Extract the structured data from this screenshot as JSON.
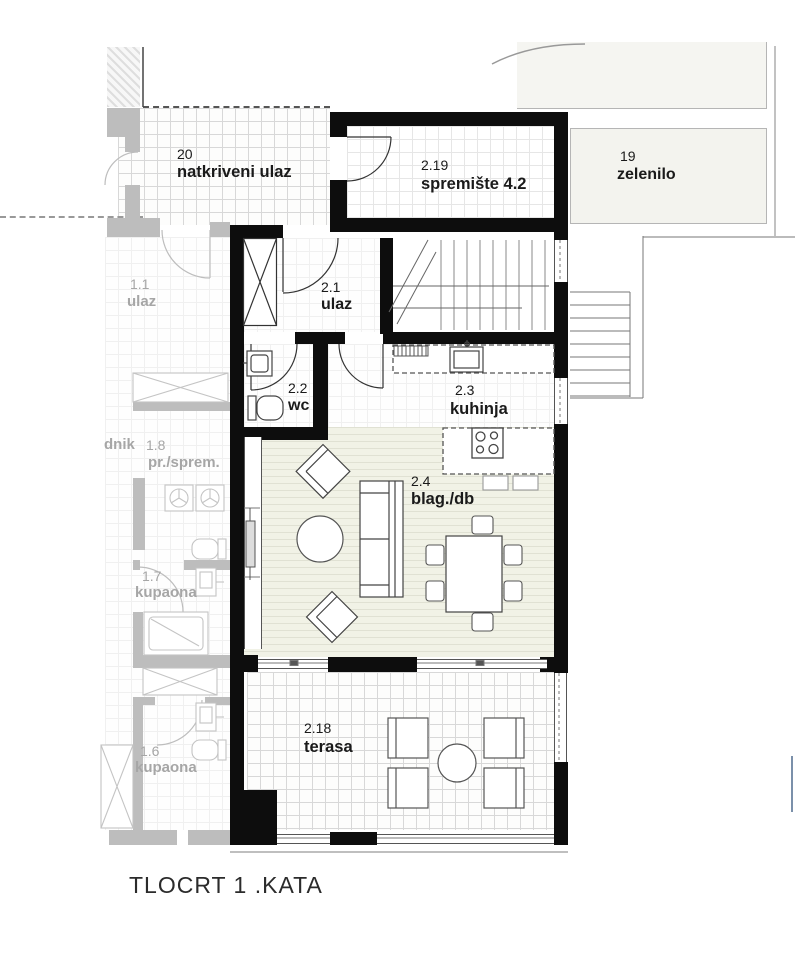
{
  "page_title": "TLOCRT 1 .KATA",
  "plan": {
    "rooms": {
      "natkriveni": {
        "number": "20",
        "name": "natkriveni ulaz"
      },
      "spremiste": {
        "number": "2.19",
        "name": "spremište 4.2"
      },
      "zelenilo": {
        "number": "19",
        "name": "zelenilo"
      },
      "ulaz": {
        "number": "2.1",
        "name": "ulaz"
      },
      "wc": {
        "number": "2.2",
        "name": "wc"
      },
      "kuhinja": {
        "number": "2.3",
        "name": "kuhinja"
      },
      "blag": {
        "number": "2.4",
        "name": "blag./db"
      },
      "terasa": {
        "number": "2.18",
        "name": "terasa"
      }
    },
    "neighbor_rooms": {
      "ulaz": {
        "number": "1.1",
        "name": "ulaz"
      },
      "hodnik": {
        "name_partial": "dnik"
      },
      "sprem": {
        "number": "1.8",
        "name": "pr./sprem."
      },
      "kupaona7": {
        "number": "1.7",
        "name": "kupaona"
      },
      "kupaona6": {
        "number": "1.6",
        "name": "kupaona"
      }
    },
    "colors": {
      "wall": "#0d0d0d",
      "neighbor_wall": "#bdbdbd",
      "neighbor_text": "#a6a6a6",
      "text": "#1a1a1a",
      "wood_floor": "#f1f2e6",
      "greenery_fill": "#f3f3ee"
    }
  }
}
